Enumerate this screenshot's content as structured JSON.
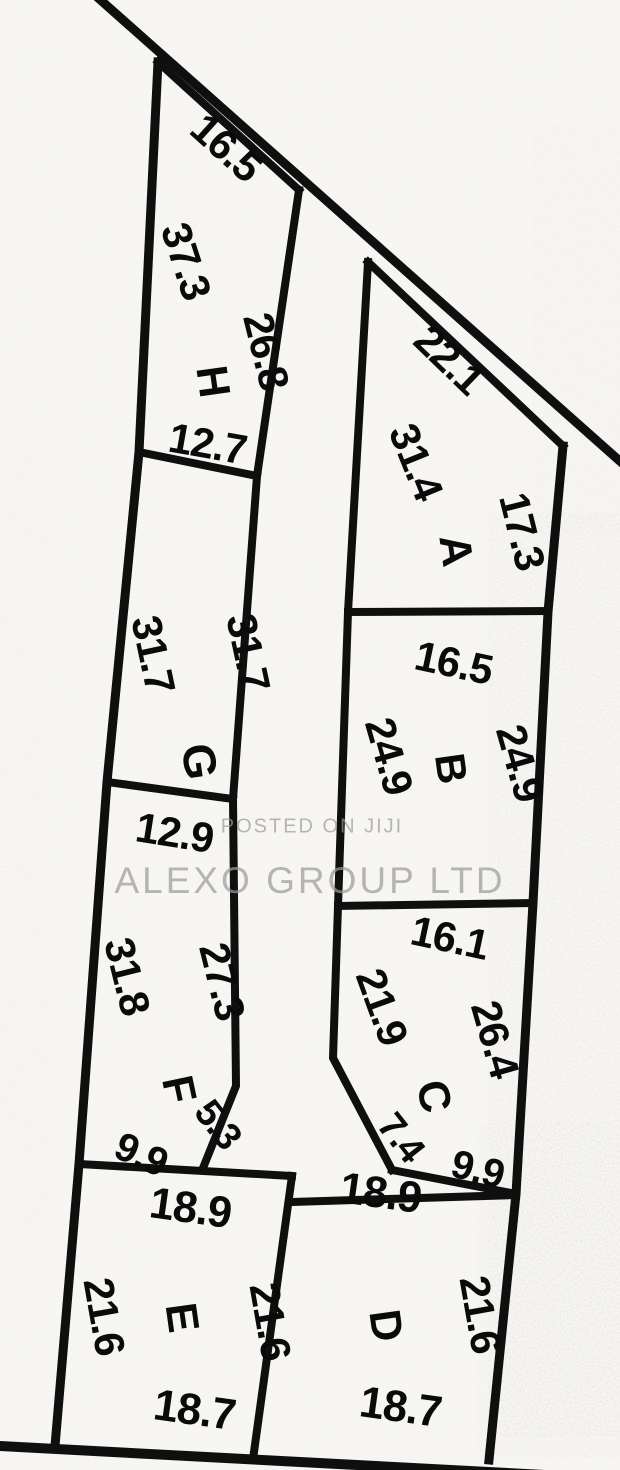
{
  "watermark": {
    "line1": "POSTED ON JIJI",
    "line2": "ALEXO GROUP LTD"
  },
  "colors": {
    "ink": "#141414",
    "paper": "#f7f6f2",
    "watermark": "#9a9a9a"
  },
  "plots": {
    "H": {
      "label": "H",
      "top": "16.5",
      "left": "37.3",
      "right": "26.8",
      "bottom": "12.7"
    },
    "A": {
      "label": "A",
      "top": "22.1",
      "left": "31.4",
      "right": "17.3"
    },
    "G": {
      "label": "G",
      "left": "31.7",
      "right": "31.7",
      "bottom": "12.9"
    },
    "B": {
      "label": "B",
      "top": "16.5",
      "left": "24.9",
      "right": "24.9"
    },
    "F": {
      "label": "F",
      "left": "31.8",
      "right": "27.3",
      "cut": "5.3",
      "bottom": "9.9"
    },
    "C": {
      "label": "C",
      "top": "16.1",
      "left": "21.9",
      "right": "26.4",
      "cut": "7.4",
      "bottom": "9.9"
    },
    "E": {
      "label": "E",
      "top": "18.9",
      "left": "21.6",
      "right": "21.6",
      "bottom": "18.7"
    },
    "D": {
      "label": "D",
      "top": "18.9",
      "right": "21.6",
      "bottom": "18.7"
    }
  }
}
